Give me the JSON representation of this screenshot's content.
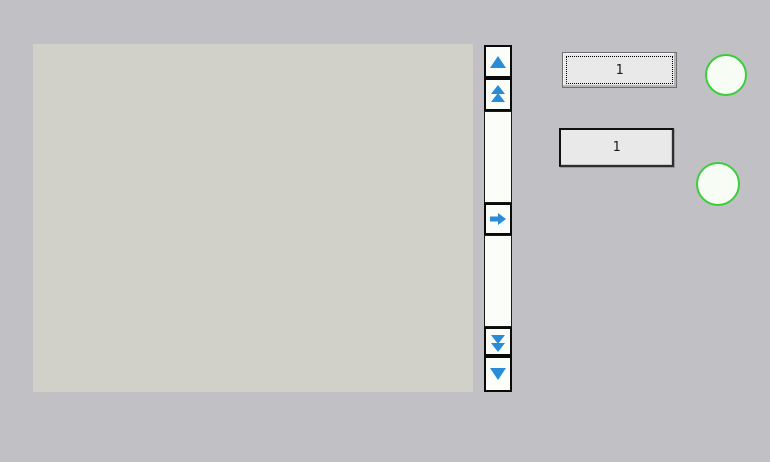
{
  "window": {
    "width": 770,
    "height": 462
  },
  "colors": {
    "window-bg": "#c1c1c5",
    "canvas-bg": "#d1d1c9",
    "control-bg": "#fafdf8",
    "control-border": "#0a0a0a",
    "arrow-blue": "#288cd7",
    "indicator-green": "#3ccd3c",
    "indicator-fill": "#f7fdf5",
    "field-bg": "#e9e9e9",
    "field-text": "#1a1a1a"
  },
  "scroll_controls": {
    "buttons": [
      {
        "id": "scroll-up",
        "icon": "arrow-up-icon"
      },
      {
        "id": "scroll-page-up",
        "icon": "double-arrow-up-icon"
      },
      {
        "id": "scroll-right",
        "icon": "arrow-right-icon"
      },
      {
        "id": "scroll-page-down",
        "icon": "double-arrow-down-icon"
      },
      {
        "id": "scroll-down",
        "icon": "arrow-down-icon"
      }
    ]
  },
  "fields": {
    "top": {
      "value": "1",
      "focused": true
    },
    "bottom": {
      "value": "1",
      "focused": false
    }
  },
  "indicators": {
    "top": {
      "shape": "circle"
    },
    "bottom": {
      "shape": "circle"
    }
  }
}
